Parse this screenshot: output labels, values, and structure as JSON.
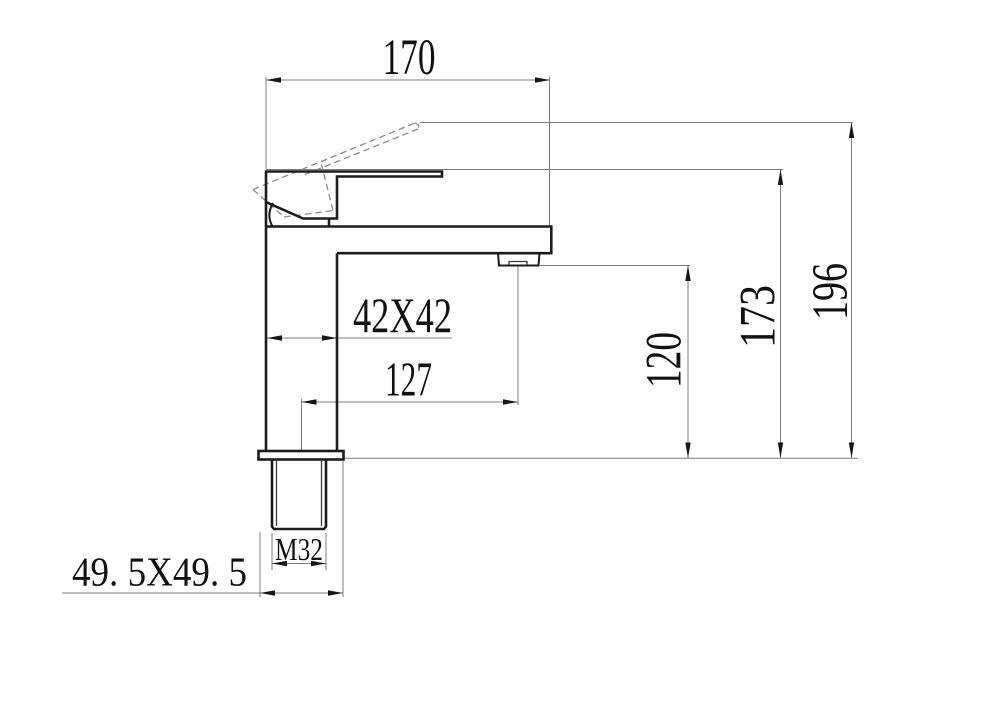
{
  "drawing": {
    "kind": "faucet-dimension-drawing",
    "labels": {
      "top_width": "170",
      "overall_height": "196",
      "body_height": "173",
      "spout_height": "120",
      "body_section": "42X42",
      "spout_offset": "127",
      "thread": "M32",
      "base_section": "49. 5X49. 5"
    },
    "colors": {
      "outline": "#1c1c1c",
      "dimension_line": "#7d7d7d",
      "dashed_line": "#8a8a8a",
      "text": "#111111",
      "background": "#ffffff"
    }
  }
}
